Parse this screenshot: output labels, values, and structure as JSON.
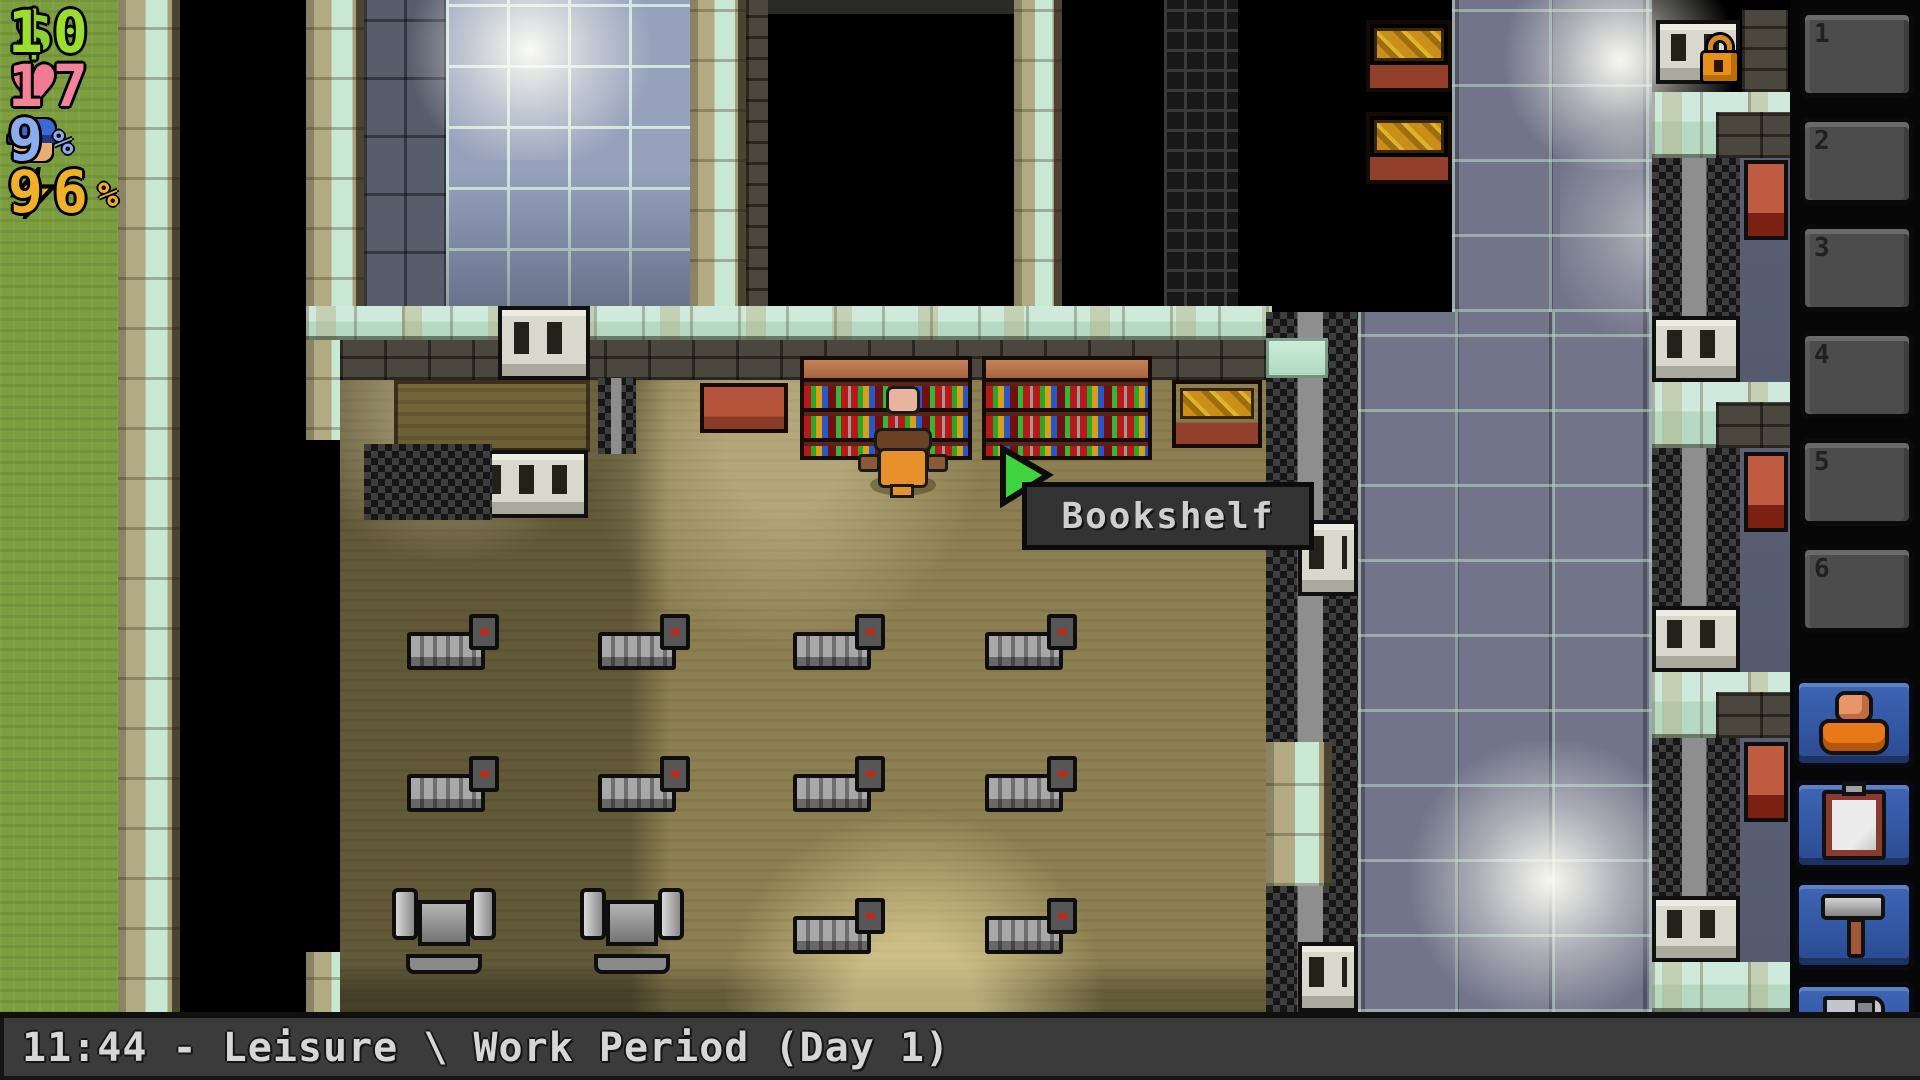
{
  "hud": {
    "money": {
      "icon": "dollar-icon",
      "glyph": "$",
      "value": "10",
      "suffix": "",
      "color": "#9ade2e"
    },
    "health": {
      "icon": "heart-icon",
      "glyph": "♥",
      "value": "17",
      "suffix": "",
      "color": "#f4839a"
    },
    "guard_heat": {
      "icon": "guard-icon",
      "value": "9",
      "suffix": "%",
      "color": "#8cacf0"
    },
    "energy": {
      "icon": "energy-icon",
      "value": "96",
      "suffix": "%",
      "color": "#f0b028"
    }
  },
  "tooltip": {
    "label": "Bookshelf"
  },
  "status_bar": {
    "text": "11:44 - Leisure \\ Work Period (Day 1)"
  },
  "sidebar": {
    "inventory_slots": [
      {
        "number": "1"
      },
      {
        "number": "2"
      },
      {
        "number": "3"
      },
      {
        "number": "4"
      },
      {
        "number": "5"
      },
      {
        "number": "6"
      }
    ],
    "buttons": [
      {
        "id": "prisoner-profile",
        "icon": "prisoner-icon"
      },
      {
        "id": "journal",
        "icon": "clipboard-icon"
      },
      {
        "id": "crafting",
        "icon": "hammer-icon"
      },
      {
        "id": "save",
        "icon": "floppy-disk-icon"
      }
    ]
  },
  "world": {
    "hovered_object": "Bookshelf",
    "visible_objects": [
      "bookshelf",
      "wooden-desk",
      "library-bench",
      "grinder",
      "prison-bed",
      "barred-door",
      "chain-fence",
      "padlock",
      "prisoner-character",
      "red-table"
    ]
  },
  "colors": {
    "button_blue": "#3d66b6",
    "tooltip_bg": "#333333",
    "status_bar_bg": "#3b3b3b",
    "slot_bg": "#4c4c4c",
    "cursor_green": "#3fd43f",
    "floor_wood": "#8c7f51",
    "grass": "#7c9e3f",
    "bookshelf_wood": "#a9643f"
  }
}
